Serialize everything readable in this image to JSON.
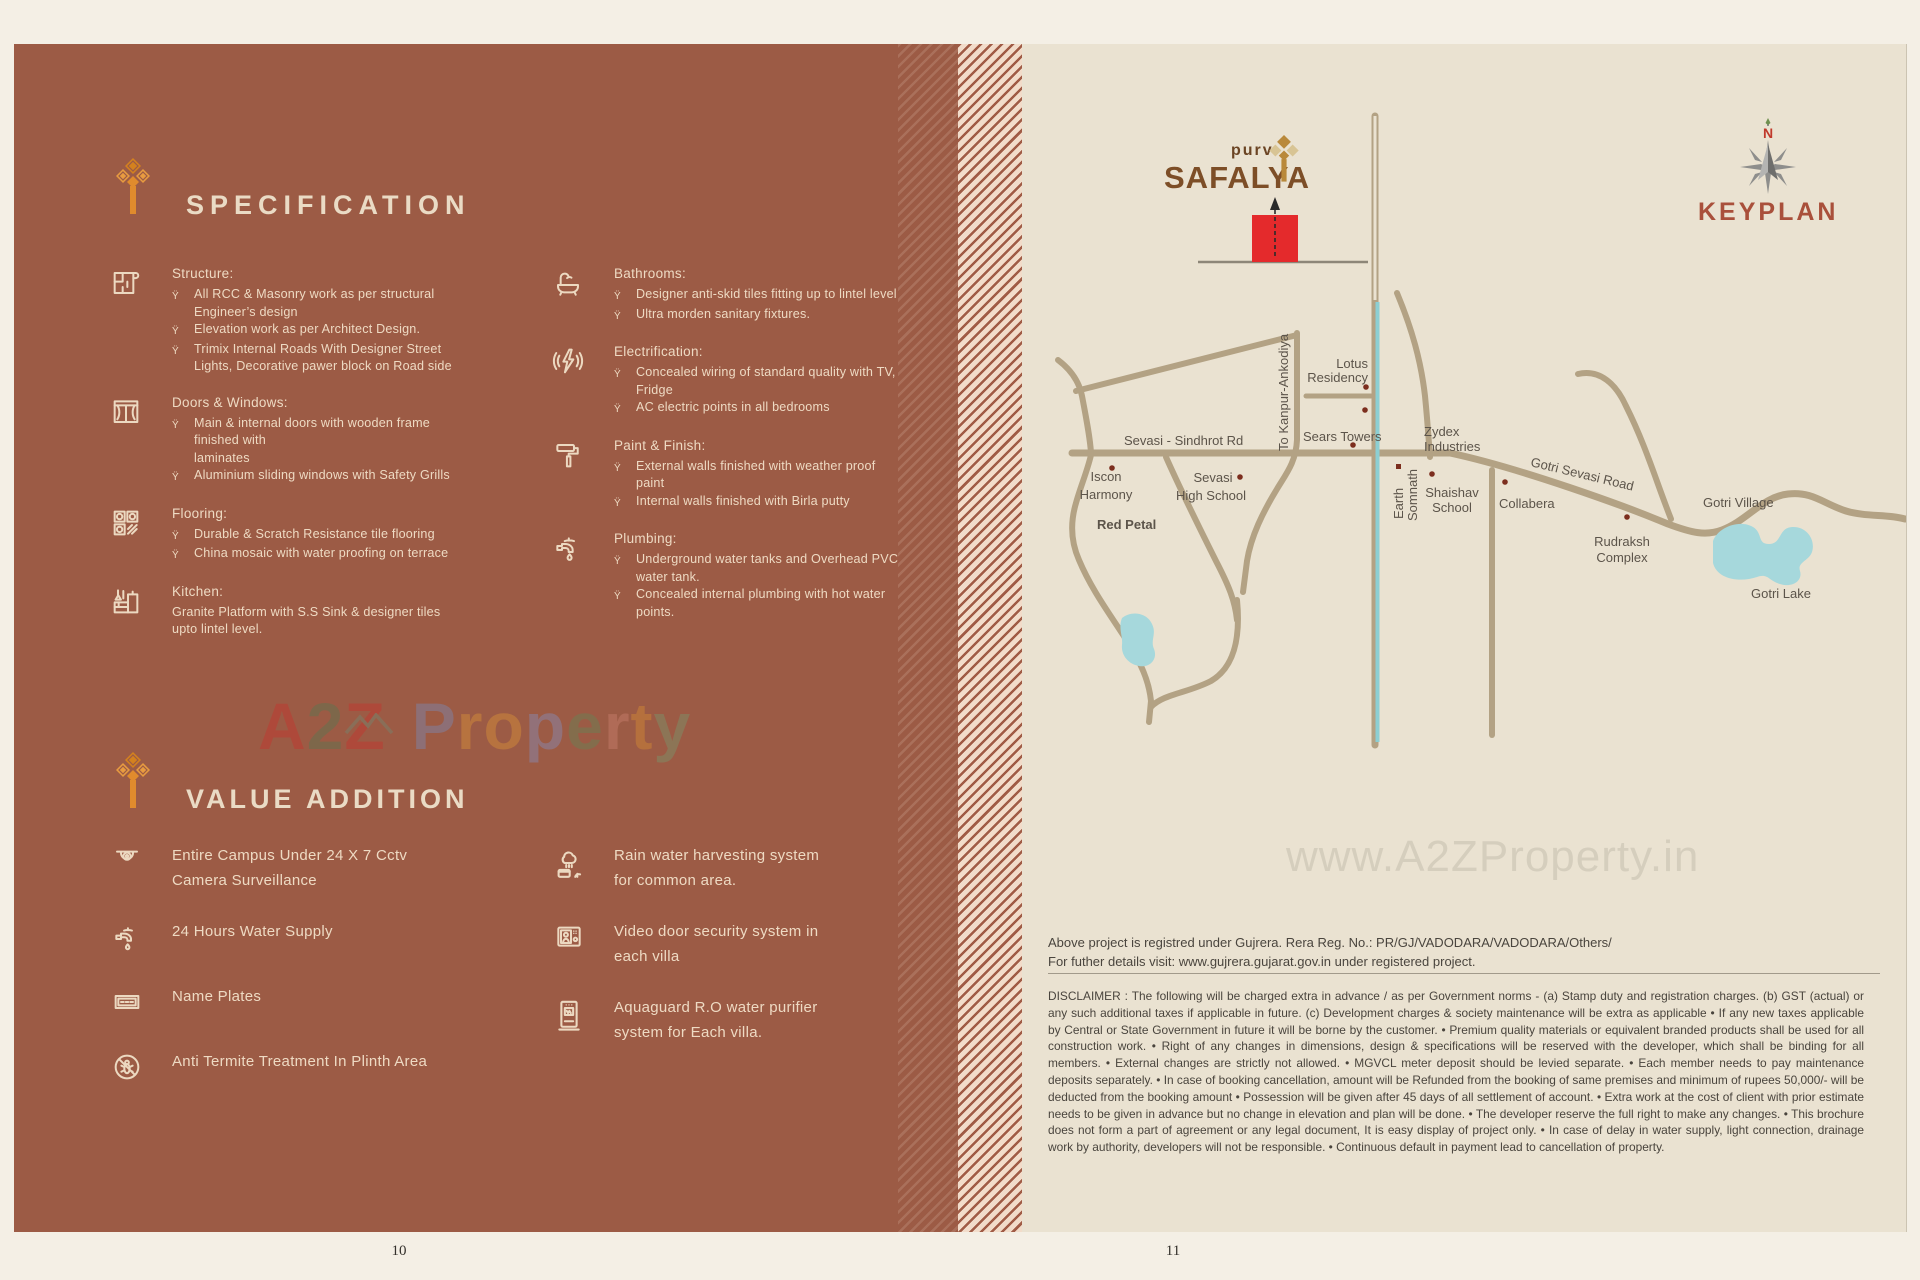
{
  "colors": {
    "left_page_bg": "#9c5b45",
    "accent_orange": "#e08b2d",
    "cream_text": "#eedac3",
    "right_page_bg": "#eae2d1",
    "road_tan": "#b3a284",
    "canal_teal": "#8ccfd3",
    "lake_teal": "#a6d8dc",
    "marker_red": "#e42a2c",
    "keyplan_title": "#a9503b",
    "map_label": "#5c544a"
  },
  "spec": {
    "heading": "SPECIFICATION",
    "bullet": "Ÿ",
    "groups_left": [
      {
        "title": "Structure:",
        "bullets": [
          "All RCC & Masonry work as per structural\nEngineer’s design",
          "Elevation work as per Architect Design.",
          "Trimix Internal Roads With Designer Street\nLights, Decorative pawer block on Road side"
        ]
      },
      {
        "title": "Doors & Windows:",
        "bullets": [
          "Main & internal doors with wooden frame\nfinished with\nlaminates",
          "Aluminium sliding windows with Safety Grills"
        ]
      },
      {
        "title": "Flooring:",
        "bullets": [
          "Durable & Scratch Resistance tile flooring",
          "China mosaic with water proofing on terrace"
        ]
      },
      {
        "title": "Kitchen:",
        "note": "Granite Platform with S.S Sink & designer tiles\nupto lintel level."
      }
    ],
    "groups_right": [
      {
        "title": "Bathrooms:",
        "bullets": [
          "Designer anti-skid tiles fitting up to lintel level",
          "Ultra morden sanitary fixtures."
        ]
      },
      {
        "title": "Electrification:",
        "bullets": [
          "Concealed wiring of standard quality with TV,\nFridge",
          "AC electric points in all bedrooms"
        ]
      },
      {
        "title": "Paint & Finish:",
        "bullets": [
          "External walls finished with weather proof\npaint",
          "Internal walls finished with Birla putty"
        ]
      },
      {
        "title": "Plumbing:",
        "bullets": [
          "Underground water tanks and Overhead PVC\nwater tank.",
          "Concealed internal plumbing with hot water\npoints."
        ]
      }
    ]
  },
  "value": {
    "heading": "VALUE ADDITION",
    "items_left": [
      "Entire Campus Under 24 X 7 Cctv\nCamera Surveillance",
      "24 Hours Water Supply",
      "Name Plates",
      "Anti Termite Treatment In Plinth Area"
    ],
    "items_right": [
      "Rain water harvesting system\nfor common area.",
      "Video door security system in\neach villa",
      "Aquaguard R.O water purifier\nsystem for Each villa."
    ]
  },
  "watermarks": {
    "left_letters": [
      "A",
      "2",
      "Z",
      "P",
      "r",
      "o",
      "p",
      "e",
      "r",
      "t",
      "y"
    ],
    "right": "www.A2ZProperty.in"
  },
  "logo": {
    "prefix": "purv",
    "name": "SAFALYA"
  },
  "keyplan": {
    "title": "KEYPLAN",
    "north": "N"
  },
  "map": {
    "labels": {
      "lotus_1": "Lotus",
      "lotus_2": "Residency",
      "sears": "Sears Towers",
      "road_sevasi": "Sevasi - Sindhrot Rd",
      "kanpur": "To Kanpur-Ankodiya",
      "iscon_1": "Iscon",
      "iscon_2": "Harmony",
      "school_1": "Sevasi",
      "school_2": "High School",
      "earth_1": "Earth",
      "earth_2": "Somnath",
      "zydex_1": "Zydex",
      "zydex_2": "Industries",
      "shaishav_1": "Shaishav",
      "shaishav_2": "School",
      "collabera": "Collabera",
      "road_gotri": "Gotri Sevasi Road",
      "village": "Gotri Village",
      "rudraksh_1": "Rudraksh",
      "rudraksh_2": "Complex",
      "lake": "Gotri Lake",
      "red_petal": "Red Petal"
    }
  },
  "footer": {
    "rera_line1": "Above project is registred under Gujrera. Rera Reg. No.: PR/GJ/VADODARA/VADODARA/Others/",
    "rera_line2": "For futher details visit: www.gujrera.gujarat.gov.in under registered project.",
    "disclaimer": "DISCLAIMER : The following will be charged extra in advance / as per Government norms - (a) Stamp duty and registration charges. (b) GST (actual) or any such additional taxes if applicable in future.  (c)  Development charges & society maintenance will be extra as applicable • If any new taxes applicable by Central or State Government in future it will be borne by the customer. • Premium quality materials or equivalent branded products shall be used for all construction work. • Right of any changes in dimensions, design & specifications will be reserved with the developer, which shall be binding for all members. • External changes are strictly not allowed. • MGVCL meter deposit should be levied separate. • Each member needs to pay maintenance deposits separately. • In case of booking cancellation, amount will be Refunded from the booking of same premises and minimum of rupees 50,000/- will be deducted from the booking amount • Possession will be given after 45 days of all settlement of account. • Extra work at the cost of client with prior estimate needs to be given in advance but no change in elevation and plan will be done. • The developer reserve the full right to make any changes. • This brochure does not form a part of agreement or any legal document, It is easy display of project only. • In case of delay in water supply, light connection, drainage work by authority, developers will not be responsible. • Continuous default in payment lead to cancellation of property.",
    "page_left": "10",
    "page_right": "11"
  }
}
